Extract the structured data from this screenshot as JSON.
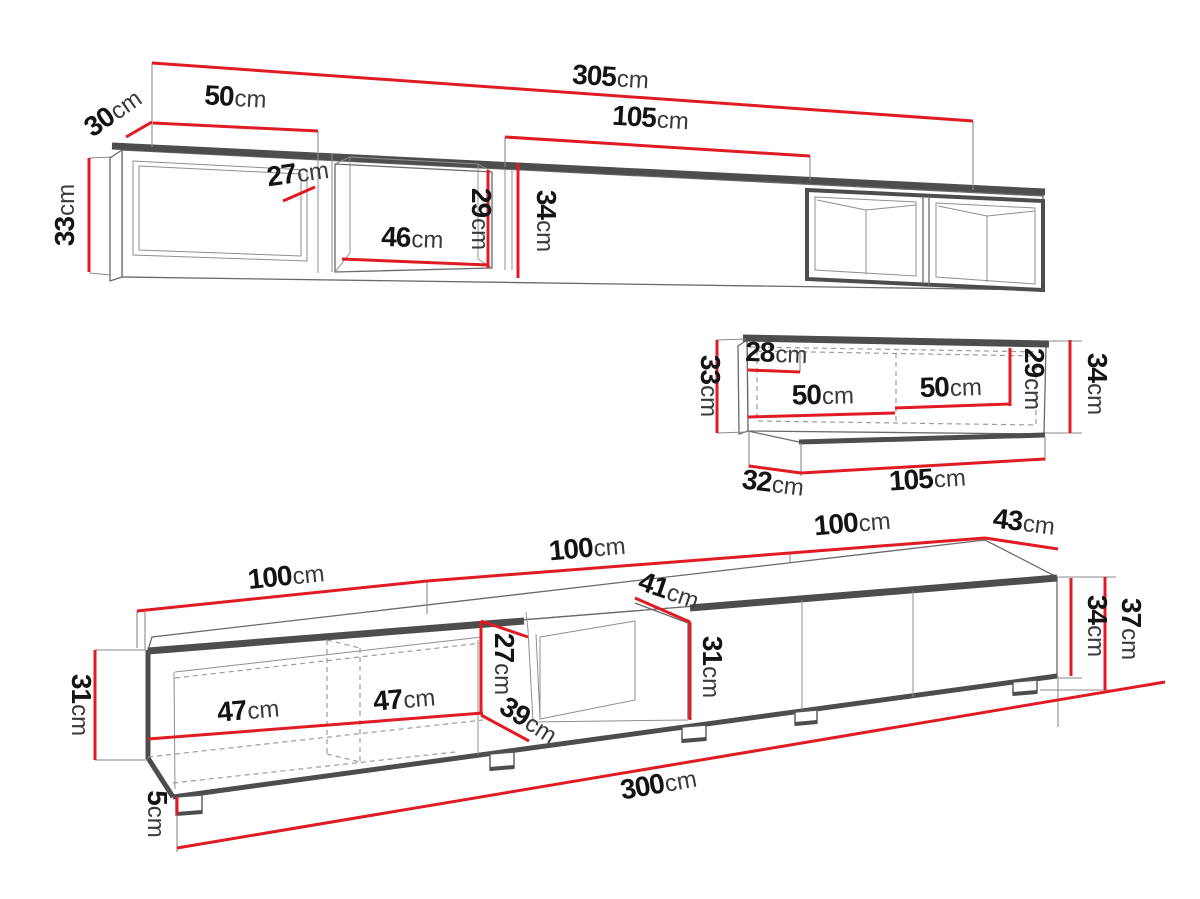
{
  "diagram": {
    "type": "furniture-dimension-drawing",
    "background": "#ffffff",
    "accent_red": "#e01b24",
    "outline_gray": "#4d4d4d",
    "unit_of_measure": "cm"
  },
  "dims": {
    "top": {
      "d305": {
        "value": "305",
        "unit": "cm"
      },
      "d30": {
        "value": "30",
        "unit": "cm"
      },
      "d50": {
        "value": "50",
        "unit": "cm"
      },
      "d33": {
        "value": "33",
        "unit": "cm"
      },
      "d27": {
        "value": "27",
        "unit": "cm"
      },
      "d46": {
        "value": "46",
        "unit": "cm"
      },
      "d29": {
        "value": "29",
        "unit": "cm"
      },
      "d34": {
        "value": "34",
        "unit": "cm"
      },
      "d105": {
        "value": "105",
        "unit": "cm"
      }
    },
    "mid": {
      "d33": {
        "value": "33",
        "unit": "cm"
      },
      "d28": {
        "value": "28",
        "unit": "cm"
      },
      "d50a": {
        "value": "50",
        "unit": "cm"
      },
      "d50b": {
        "value": "50",
        "unit": "cm"
      },
      "d29": {
        "value": "29",
        "unit": "cm"
      },
      "d34": {
        "value": "34",
        "unit": "cm"
      },
      "d32": {
        "value": "32",
        "unit": "cm"
      },
      "d105": {
        "value": "105",
        "unit": "cm"
      }
    },
    "bot": {
      "d100a": {
        "value": "100",
        "unit": "cm"
      },
      "d100b": {
        "value": "100",
        "unit": "cm"
      },
      "d100c": {
        "value": "100",
        "unit": "cm"
      },
      "d43": {
        "value": "43",
        "unit": "cm"
      },
      "d41": {
        "value": "41",
        "unit": "cm"
      },
      "d27": {
        "value": "27",
        "unit": "cm"
      },
      "d31mid": {
        "value": "31",
        "unit": "cm"
      },
      "d39": {
        "value": "39",
        "unit": "cm"
      },
      "d31": {
        "value": "31",
        "unit": "cm"
      },
      "d47a": {
        "value": "47",
        "unit": "cm"
      },
      "d47b": {
        "value": "47",
        "unit": "cm"
      },
      "d34": {
        "value": "34",
        "unit": "cm"
      },
      "d37": {
        "value": "37",
        "unit": "cm"
      },
      "d5": {
        "value": "5",
        "unit": "cm"
      },
      "d300": {
        "value": "300",
        "unit": "cm"
      }
    }
  }
}
